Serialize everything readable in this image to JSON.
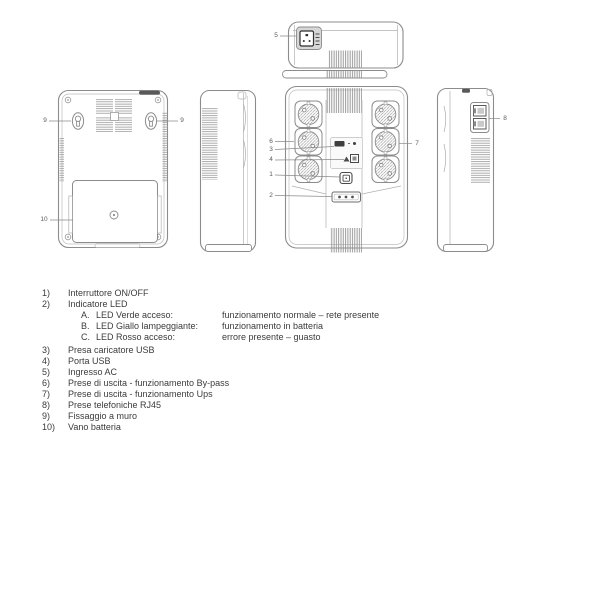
{
  "callouts": {
    "power_switch": "1",
    "led_indicator": "2",
    "usb_charger": "3",
    "usb_port": "4",
    "ac_inlet": "5",
    "bypass_outlets": "6",
    "ups_outlets": "7",
    "rj45": "8",
    "wall_mount_left": "9",
    "wall_mount_right": "9",
    "battery": "10"
  },
  "legend": {
    "items": [
      {
        "num": "1)",
        "text": "Interruttore ON/OFF"
      },
      {
        "num": "2)",
        "text": "Indicatore LED",
        "sub": [
          {
            "letter": "A.",
            "label": "LED Verde acceso:",
            "desc": "funzionamento normale – rete presente"
          },
          {
            "letter": "B.",
            "label": "LED Giallo lampeggiante:",
            "desc": "funzionamento in batteria"
          },
          {
            "letter": "C.",
            "label": "LED Rosso acceso:",
            "desc": "errore presente – guasto"
          }
        ]
      },
      {
        "num": "3)",
        "text": "Presa caricatore USB"
      },
      {
        "num": "4)",
        "text": "Porta USB"
      },
      {
        "num": "5)",
        "text": "Ingresso AC"
      },
      {
        "num": "6)",
        "text": "Prese di uscita - funzionamento By-pass"
      },
      {
        "num": "7)",
        "text": "Prese di uscita - funzionamento Ups"
      },
      {
        "num": "8)",
        "text": "Prese telefoniche RJ45"
      },
      {
        "num": "9)",
        "text": "Fissaggio a muro"
      },
      {
        "num": "10)",
        "text": "Vano batteria"
      }
    ]
  },
  "colors": {
    "line": "#8c8c8c",
    "dark_fill": "#3f3f3f",
    "text": "#3b3b3b",
    "background": "#ffffff"
  }
}
